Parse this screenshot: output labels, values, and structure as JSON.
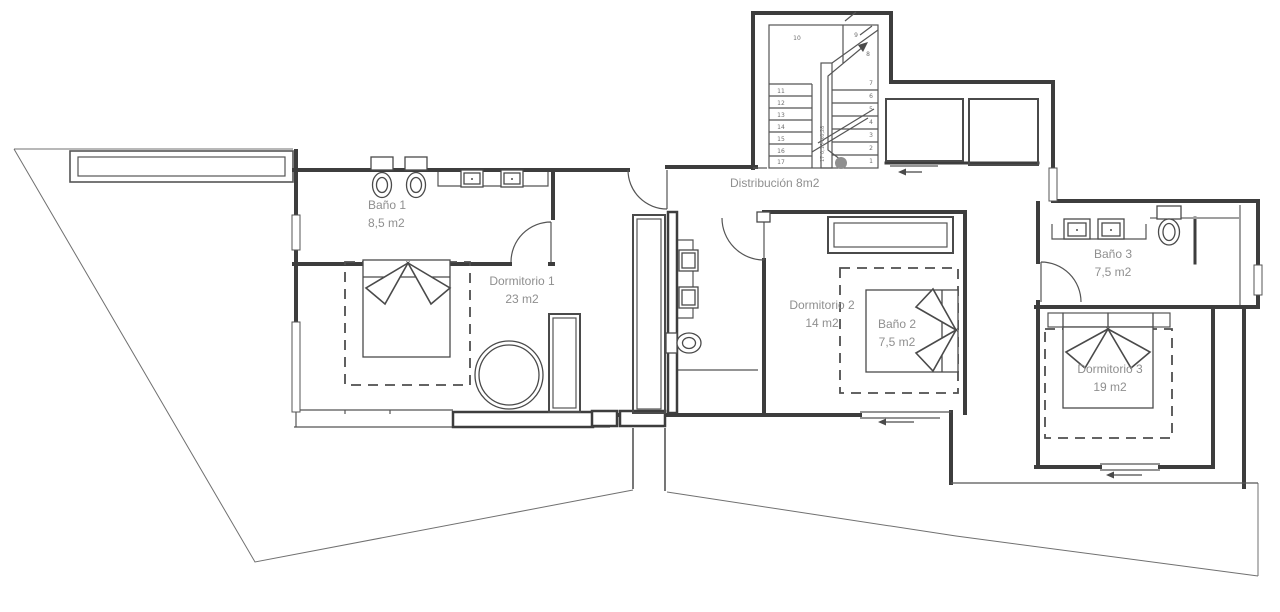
{
  "colors": {
    "wall": "#3d3d3d",
    "thin": "#555555",
    "label": "#8f8f8f",
    "terrain": "#707070",
    "dash": "#4f4f4f",
    "glass": "#9f9f9f"
  },
  "rooms": {
    "bano1": {
      "name": "Baño 1",
      "area": "8,5 m2"
    },
    "dormitorio1": {
      "name": "Dormitorio 1",
      "area": "23 m2"
    },
    "distribucion": {
      "label": "Distribución 8m2"
    },
    "dormitorio2": {
      "name": "Dormitorio 2",
      "area": "14 m2"
    },
    "bano2": {
      "name": "Baño 2",
      "area": "7,5 m2"
    },
    "bano3": {
      "name": "Baño 3",
      "area": "7,5 m2"
    },
    "dormitorio3": {
      "name": "Dormitorio 3",
      "area": "19 m2"
    }
  },
  "stairs": {
    "numbers": [
      "1",
      "2",
      "3",
      "4",
      "5",
      "6",
      "7",
      "8",
      "9",
      "10",
      "11",
      "12",
      "13",
      "14",
      "15",
      "16",
      "17"
    ],
    "annotation": "17 0,184x0,28"
  }
}
